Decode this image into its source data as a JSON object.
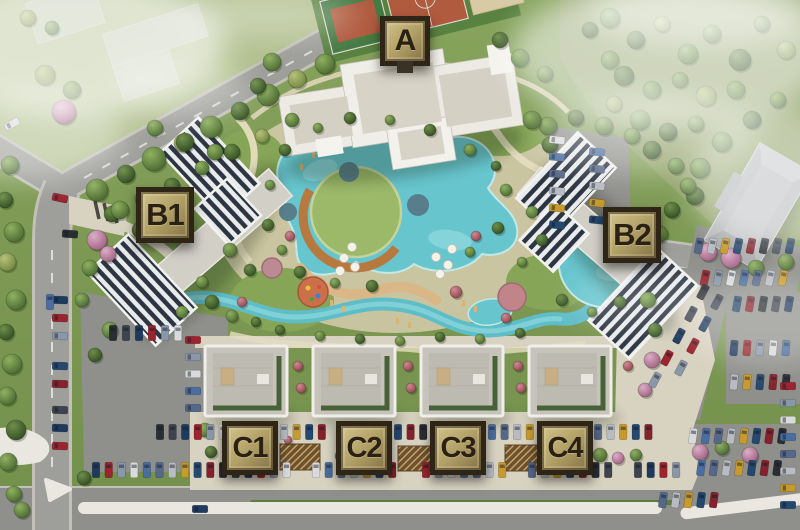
{
  "site_plan": {
    "buildings": [
      {
        "id": "a",
        "label": "A"
      },
      {
        "id": "b1",
        "label": "B1"
      },
      {
        "id": "b2",
        "label": "B2"
      },
      {
        "id": "c1",
        "label": "C1"
      },
      {
        "id": "c2",
        "label": "C2"
      },
      {
        "id": "c3",
        "label": "C3"
      },
      {
        "id": "c4",
        "label": "C4"
      }
    ],
    "palette": {
      "badge_bg_light": "#d2c38c",
      "badge_bg_dark": "#837245",
      "badge_border": "#2f2516",
      "badge_text": "#2a2013",
      "water": "#67c5ce",
      "water_light": "#9adde2",
      "lawn_island": "#9cb869",
      "grass": "#7d9b55",
      "grass_light": "#b3c190",
      "road": "#9e9e9a",
      "asphalt": "#8f8f8b",
      "paver": "#d8d2c1",
      "roof_gray": "#c6c3ba",
      "roof_white": "#f2f1ec",
      "panel_stripe": "#2c3642",
      "deck_wood": "#c08448",
      "path_cream": "#e6ddc0",
      "tree_green": "#5f8141",
      "tree_dark": "#3f5e2c",
      "tree_yellow": "#9db06a",
      "tree_pink": "#c27ba0",
      "tree_red": "#b0566e",
      "car_colors": [
        "#1e3a5f",
        "#56688a",
        "#2a2e33",
        "#d9dadb",
        "#24486e",
        "#9b242e",
        "#b8bcc2",
        "#3d4450",
        "#4a6ea0",
        "#86222c",
        "#8a97a8",
        "#c79a2d"
      ]
    }
  }
}
